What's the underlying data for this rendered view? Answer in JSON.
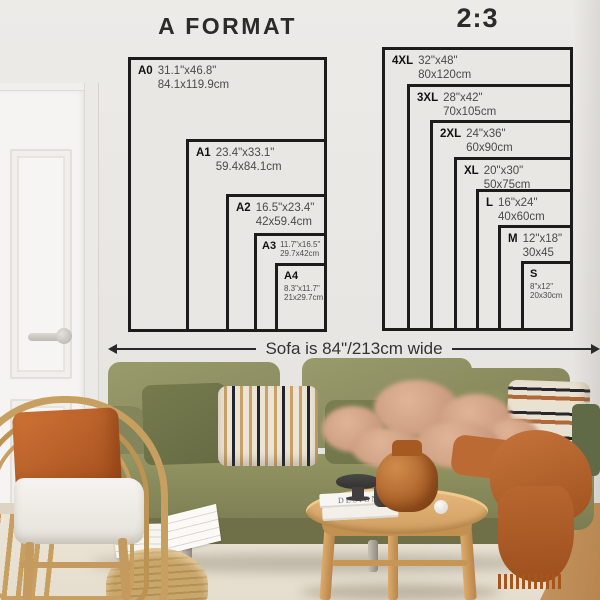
{
  "charts": {
    "a_format": {
      "title": "A FORMAT",
      "sizes": [
        {
          "code": "A0",
          "inches": "31.1\"x46.8\"",
          "cm": "84.1x119.9cm"
        },
        {
          "code": "A1",
          "inches": "23.4\"x33.1\"",
          "cm": "59.4x84.1cm"
        },
        {
          "code": "A2",
          "inches": "16.5\"x23.4\"",
          "cm": "42x59.4cm"
        },
        {
          "code": "A3",
          "inches": "11.7\"x16.5\"",
          "cm": "29.7x42cm"
        },
        {
          "code": "A4",
          "inches": "8.3\"x11.7\"",
          "cm": "21x29.7cm"
        }
      ]
    },
    "two_three": {
      "title": "2:3",
      "sizes": [
        {
          "code": "4XL",
          "inches": "32\"x48\"",
          "cm": "80x120cm"
        },
        {
          "code": "3XL",
          "inches": "28\"x42\"",
          "cm": "70x105cm"
        },
        {
          "code": "2XL",
          "inches": "24\"x36\"",
          "cm": "60x90cm"
        },
        {
          "code": "XL",
          "inches": "20\"x30\"",
          "cm": "50x75cm"
        },
        {
          "code": "L",
          "inches": "16\"x24\"",
          "cm": "40x60cm"
        },
        {
          "code": "M",
          "inches": "12\"x18\"",
          "cm": "30x45"
        },
        {
          "code": "S",
          "inches": "8\"x12\"",
          "cm": "20x30cm"
        }
      ]
    }
  },
  "sofa_note": {
    "label": "Sofa is 84\"/213cm wide"
  },
  "decor": {
    "book_spine": "DESIGN"
  },
  "colors": {
    "chart_ink": "#1c1c1c",
    "wall": "#e8e6e2",
    "sofa_olive": "#8b8c5e",
    "pillow_orange": "#b95f2d",
    "throw_rust": "#b0602a",
    "rattan": "#c79f60",
    "table_wood": "#d8a766",
    "vase_amber": "#a65a22",
    "rug_cream": "#ece5d7"
  }
}
